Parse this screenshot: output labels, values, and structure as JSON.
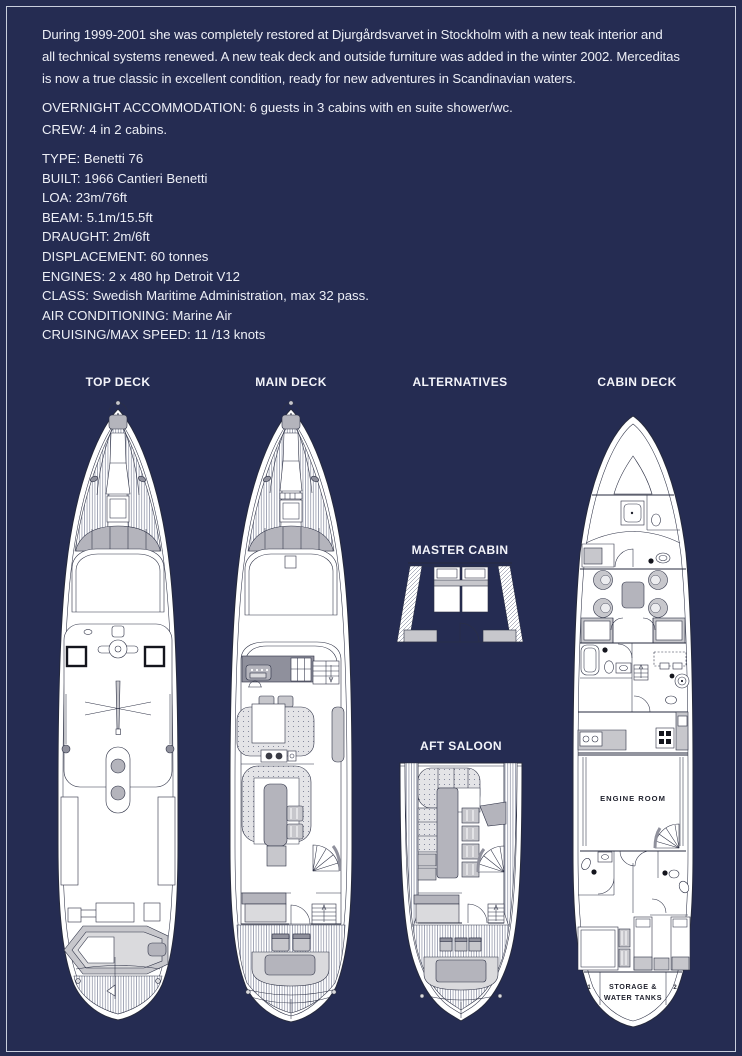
{
  "page": {
    "background": "#252c52",
    "frame_color": "#c9cedd",
    "text_color": "#edeff6"
  },
  "intro": [
    "During 1999-2001 she was completely restored at Djurgårdsvarvet in Stockholm with a new teak interior and",
    "all technical systems renewed. A new teak deck and outside furniture was added in the winter 2002. Merceditas",
    "is now a true classic in excellent condition, ready for new adventures in Scandinavian waters."
  ],
  "accommodation": [
    "OVERNIGHT ACCOMMODATION: 6 guests in 3 cabins with en suite shower/wc.",
    "CREW: 4 in 2 cabins."
  ],
  "specs": [
    "TYPE: Benetti 76",
    "BUILT: 1966 Cantieri Benetti",
    "LOA: 23m/76ft",
    "BEAM: 5.1m/15.5ft",
    "DRAUGHT: 2m/6ft",
    "DISPLACEMENT: 60 tonnes",
    "ENGINES: 2 x 480 hp Detroit V12",
    "CLASS: Swedish Maritime Administration, max 32 pass.",
    "AIR CONDITIONING: Marine Air",
    "CRUISING/MAX SPEED: 11 /13 knots"
  ],
  "plans": {
    "top_deck": "TOP DECK",
    "main_deck": "MAIN DECK",
    "alternatives": "ALTERNATIVES",
    "cabin_deck": "CABIN DECK",
    "master_cabin": "MASTER CABIN",
    "aft_saloon": "AFT SALOON",
    "engine_room": "ENGINE ROOM",
    "storage_line1": "STORAGE &",
    "storage_line2": "WATER TANKS",
    "tank_left": "1",
    "tank_right": "2"
  }
}
